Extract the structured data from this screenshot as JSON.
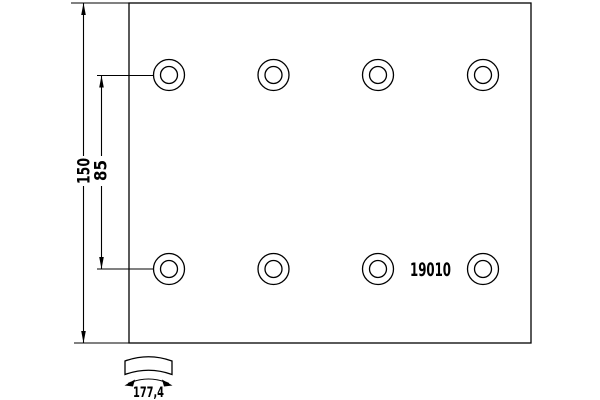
{
  "page": {
    "background": "#ffffff",
    "line_color": "#000000",
    "text_color": "#000000"
  },
  "drawing": {
    "type": "technical-drawing",
    "part_number": "19010",
    "dim_height_label": "150",
    "dim_hole_spacing_label": "85",
    "dim_arc_width_label": "177,4",
    "plate": {
      "left": 129,
      "top": 3,
      "right": 531,
      "bottom": 343
    },
    "holes": {
      "columns_x": [
        169,
        273.5,
        378,
        483
      ],
      "rows_y": [
        75,
        269
      ],
      "outer_radius": 15.5,
      "inner_radius": 8.5
    }
  }
}
